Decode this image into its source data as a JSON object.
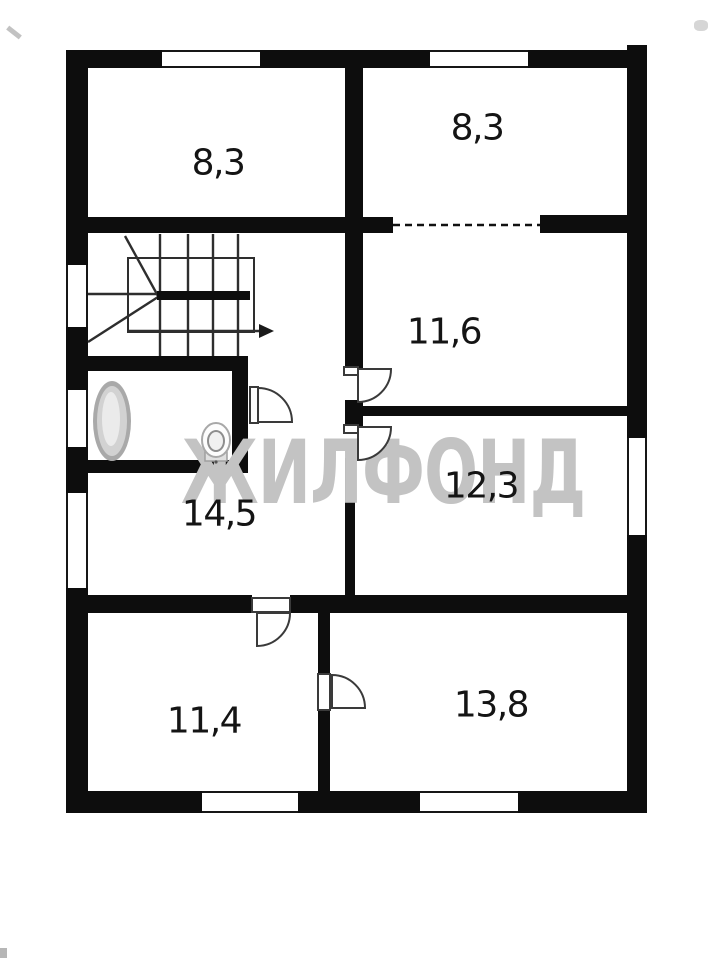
{
  "title": "floor-plan",
  "watermark": {
    "text": "ЖИЛФОНД",
    "color": "#c3c3c3"
  },
  "rooms": [
    {
      "id": "room-top-left",
      "area_label": "8,3"
    },
    {
      "id": "room-top-right",
      "area_label": "8,3"
    },
    {
      "id": "room-middle-right",
      "area_label": "11,6"
    },
    {
      "id": "room-right",
      "area_label": "12,3"
    },
    {
      "id": "hall-middle-left",
      "area_label": "14,5"
    },
    {
      "id": "room-bottom-left",
      "area_label": "11,4"
    },
    {
      "id": "room-bottom-right",
      "area_label": "13,8"
    }
  ],
  "icons": [
    "stairs-icon",
    "stairs-direction-arrow-icon",
    "bathtub-icon",
    "toilet-icon",
    "door-swing-icon-bathroom",
    "door-swing-icon-room-11-6",
    "door-swing-icon-room-12-3",
    "door-swing-icon-room-11-4",
    "door-swing-icon-room-13-8"
  ],
  "colors": {
    "wall": "#0d0d0d",
    "thin_line": "#2e2e2e",
    "background": "#ffffff",
    "watermark": "#c3c3c3",
    "label_text": "#141414"
  }
}
